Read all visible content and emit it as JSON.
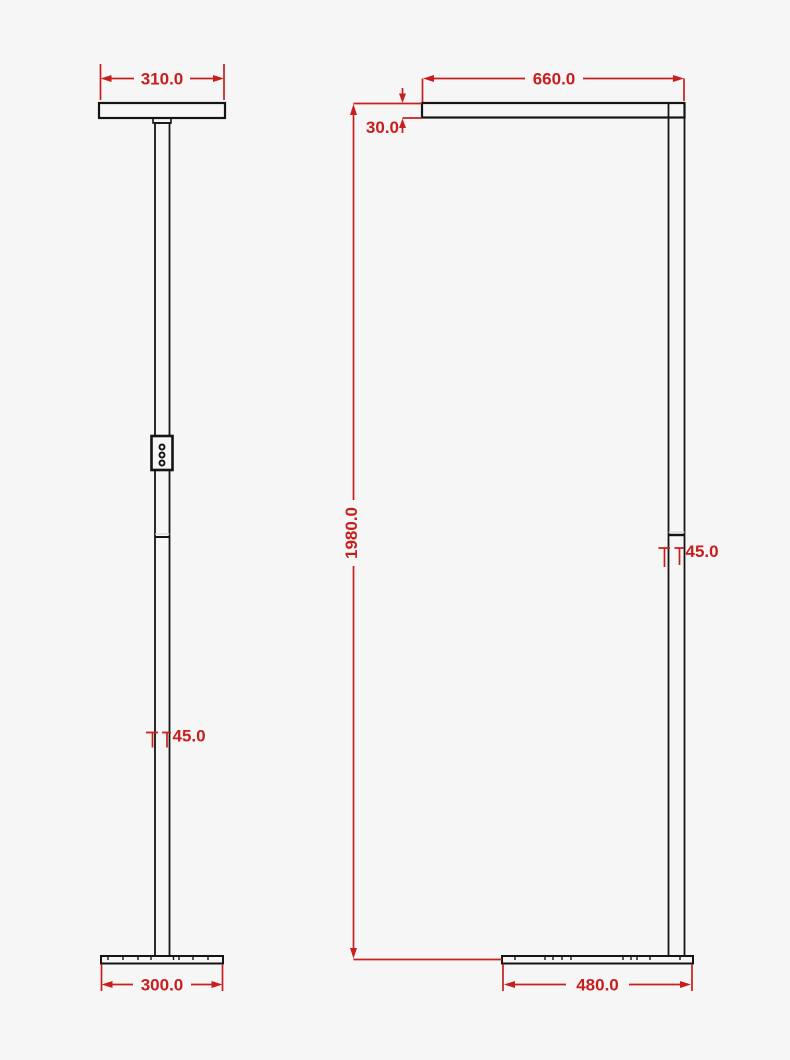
{
  "drawing": {
    "type": "technical-dimension-drawing",
    "subject": "floor-lamp two-view orthographic drawing",
    "background_color": "#f6f6f6",
    "outline_color": "#141414",
    "dimension_color": "#c81e1e",
    "views": {
      "side": {
        "label": "side view (left)",
        "dims": {
          "head_width": "310.0",
          "pole_width": "45.0",
          "base_depth": "300.0"
        }
      },
      "front": {
        "label": "front view (right)",
        "dims": {
          "bar_length": "660.0",
          "bar_thickness": "30.0",
          "total_height": "1980.0",
          "pole_width": "45.0",
          "base_width": "480.0"
        }
      }
    }
  }
}
